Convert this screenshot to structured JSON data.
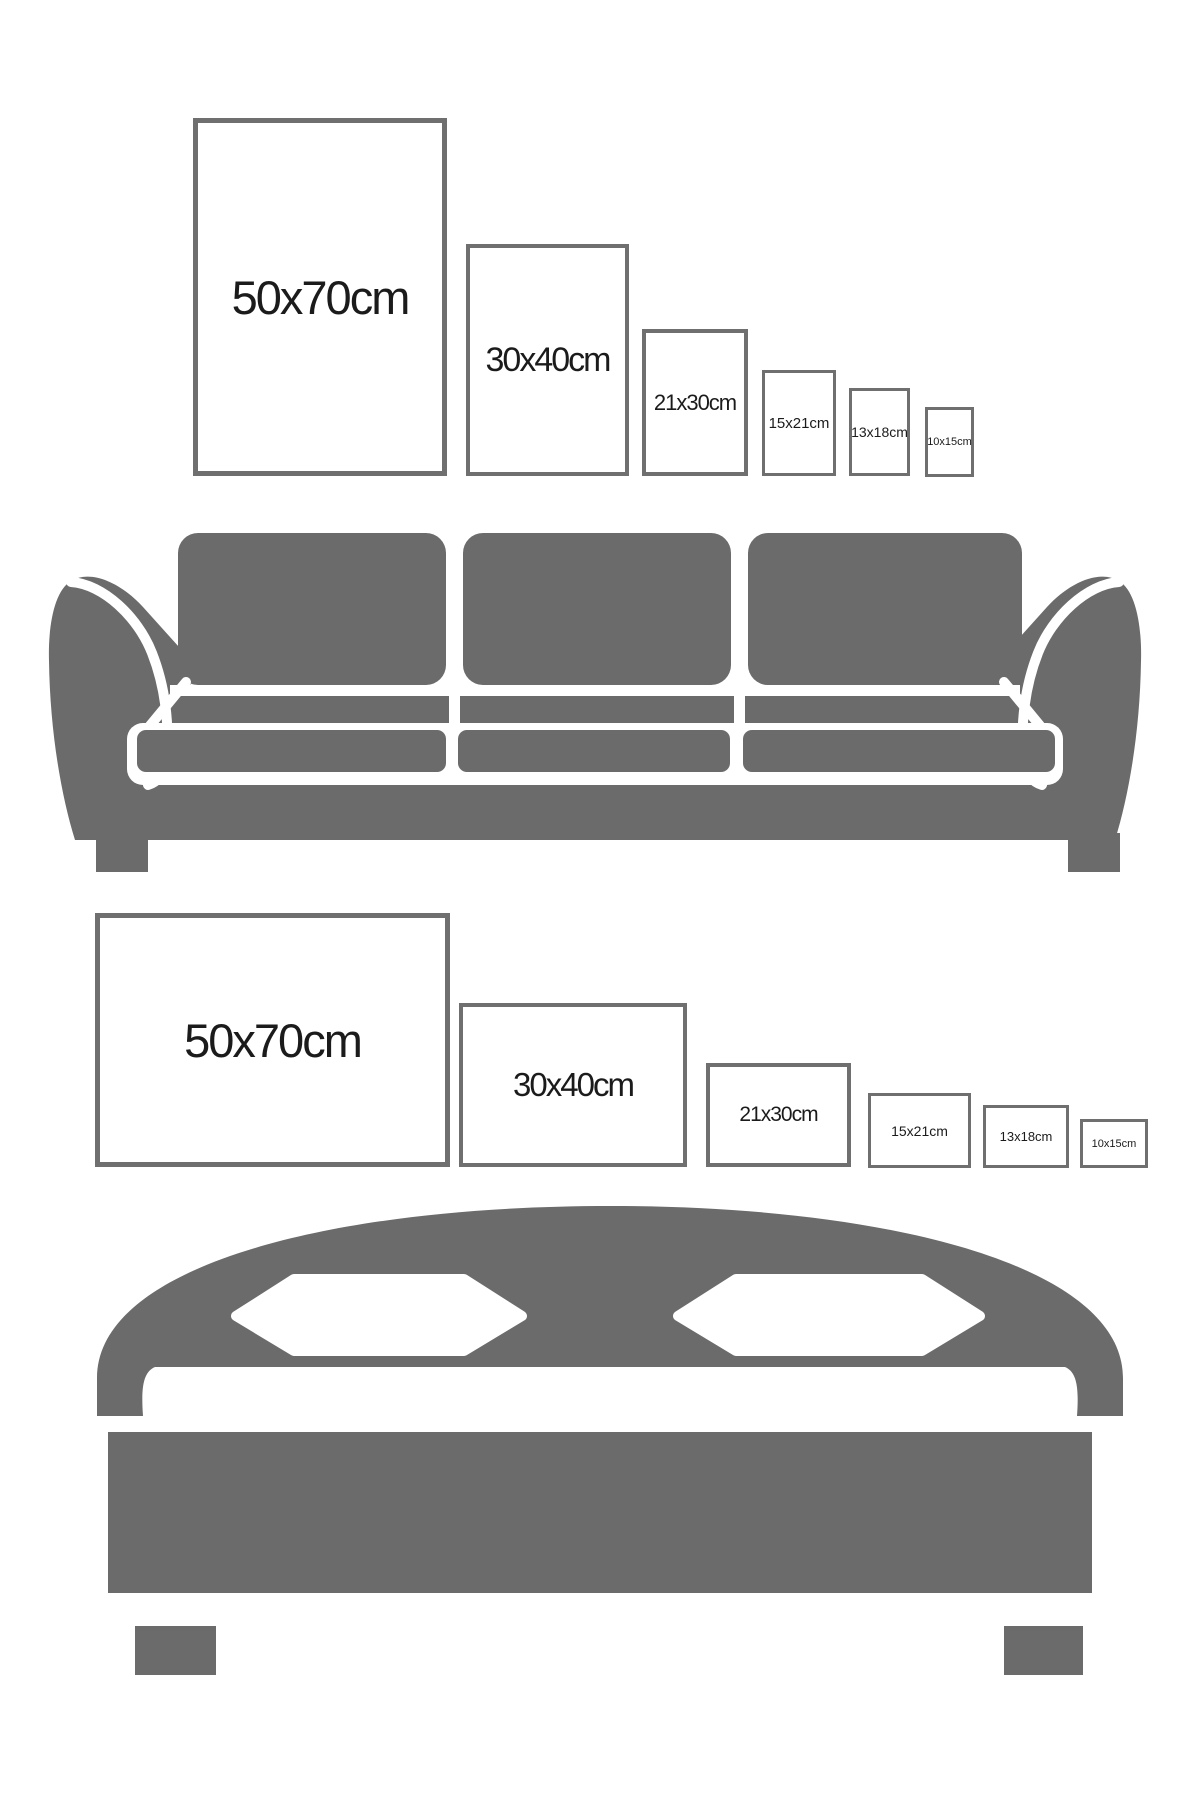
{
  "diagram": {
    "description": "Poster frame size comparison chart shown above a sofa (portrait orientation) and above a bed (landscape orientation)",
    "colors": {
      "background": "#ffffff",
      "furniture_gray": "#6b6b6b",
      "frame_border_gray": "#6f6f6f",
      "label_text": "#1b1b1b"
    },
    "top_section": {
      "orientation": "portrait",
      "furniture": "sofa",
      "frames": [
        "50x70cm",
        "30x40cm",
        "21x30cm",
        "15x21cm",
        "13x18cm",
        "10x15cm"
      ]
    },
    "bottom_section": {
      "orientation": "landscape",
      "furniture": "bed",
      "frames": [
        "50x70cm",
        "30x40cm",
        "21x30cm",
        "15x21cm",
        "13x18cm",
        "10x15cm"
      ]
    }
  }
}
